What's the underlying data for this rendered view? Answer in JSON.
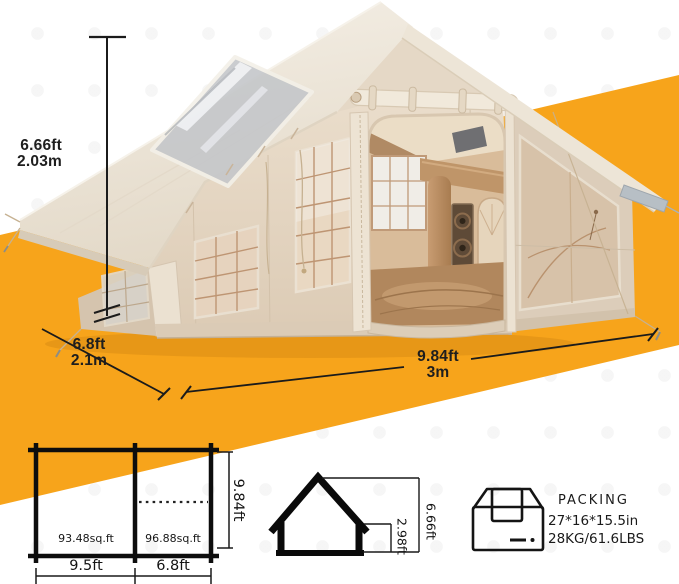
{
  "meta": {
    "description": "Inflatable cabin tent dimension sheet"
  },
  "colors": {
    "accent_orange": "#F7A41B",
    "tent_cream": "#F0EADF",
    "line_dark": "#1B1B1B"
  },
  "tent_photo": {
    "height": {
      "imperial": "6.66ft",
      "metric": "2.03m"
    },
    "side_width": {
      "imperial": "6.8ft",
      "metric": "2.1m"
    },
    "front_width": {
      "imperial": "9.84ft",
      "metric": "3m"
    }
  },
  "floor_plan": {
    "left_area": "93.48sq.ft",
    "right_area": "96.88sq.ft",
    "left_width": "9.5ft",
    "right_width": "6.8ft",
    "depth": "9.84ft"
  },
  "elevation": {
    "peak_height": "6.66ft",
    "wall_height": "2.98ft"
  },
  "packing": {
    "title": "PACKING",
    "size": "27*16*15.5in",
    "weight": "28KG/61.6LBS"
  }
}
